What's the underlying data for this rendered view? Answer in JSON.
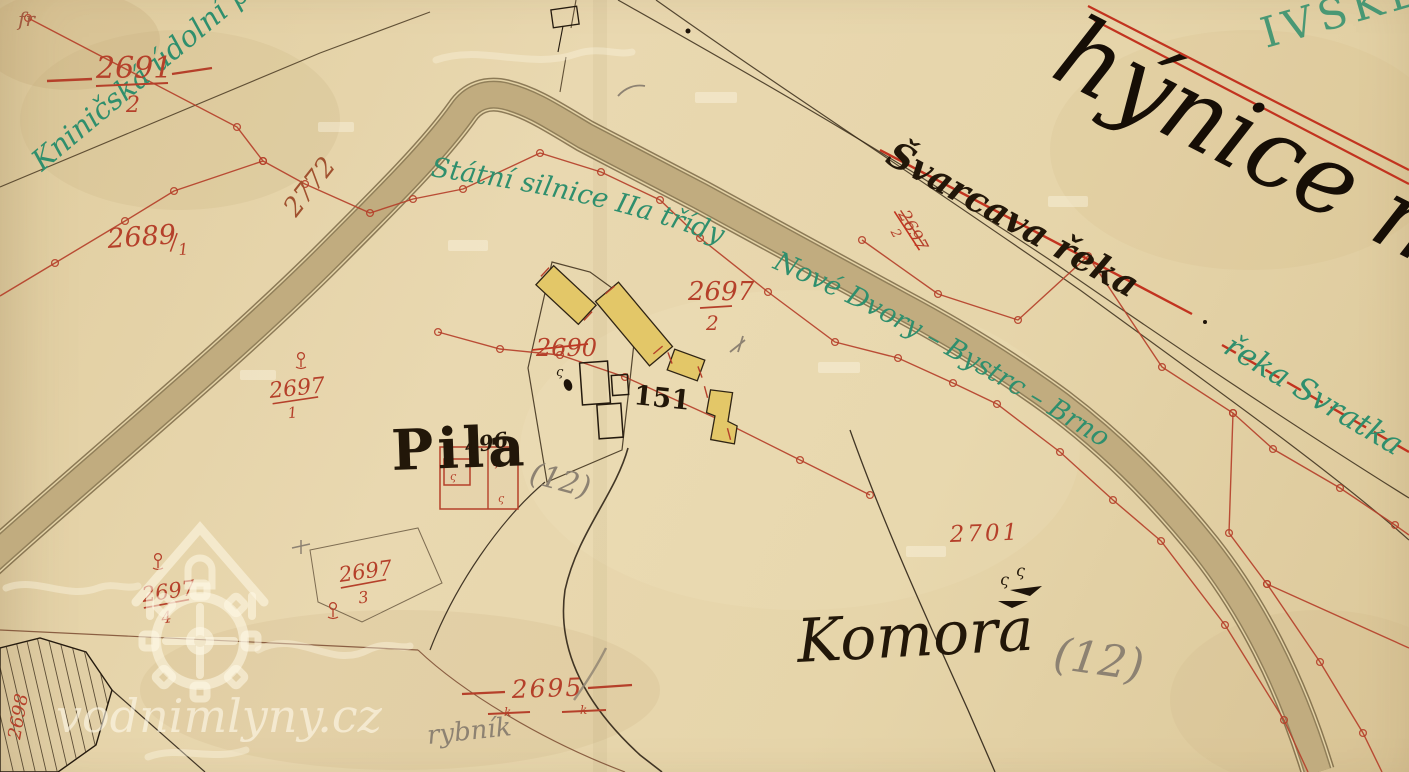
{
  "watermark": {
    "site": "vodnimlyny.cz"
  },
  "labels": {
    "valley_green": "Kniničská údolní př",
    "road_class": "Státní silnice IIa třídy",
    "road_route": "Nové Dvory – Bystrc – Brno",
    "river_old_black": "Švarcava řeka",
    "river_new_green": "řeka Svratka",
    "corner_script_black": "hýnice m",
    "corner_stamp_green": "IVSKÉ",
    "mill": "Pila",
    "chamber": "Komora",
    "pond_pencil": "rybník",
    "note_12_mill": "(12)",
    "note_12_chamber": "(12)",
    "house_151": "151",
    "house_496": "496",
    "mark_k_left": "k",
    "mark_k_right": "k",
    "corner_mark": "fr"
  },
  "parcels": {
    "p2691": {
      "num": "2691",
      "den": "2"
    },
    "p2689": {
      "num": "2689",
      "den": "1"
    },
    "p2772": {
      "num": "2772"
    },
    "p2690": {
      "num": "2690"
    },
    "p2695": {
      "num": "2695"
    },
    "p2701": {
      "num": "2701"
    },
    "p2698": {
      "num": "2698"
    },
    "p2697_1": {
      "num": "2697",
      "den": "1"
    },
    "p2697_2": {
      "num": "2697",
      "den": "2"
    },
    "p2697_2_struck": {
      "num": "2697",
      "den": "2"
    },
    "p2697_3": {
      "num": "2697",
      "den": "3"
    },
    "p2697_4": {
      "num": "2697",
      "den": "4"
    }
  },
  "colors": {
    "paper": "#e7d7ae",
    "red_ink": "#b5402a",
    "green_ink": "#2f8f6d",
    "black_ink": "#221709",
    "brown_line": "#4a3a22",
    "road_fill": "#c9b486",
    "pencil": "#8d8272"
  }
}
